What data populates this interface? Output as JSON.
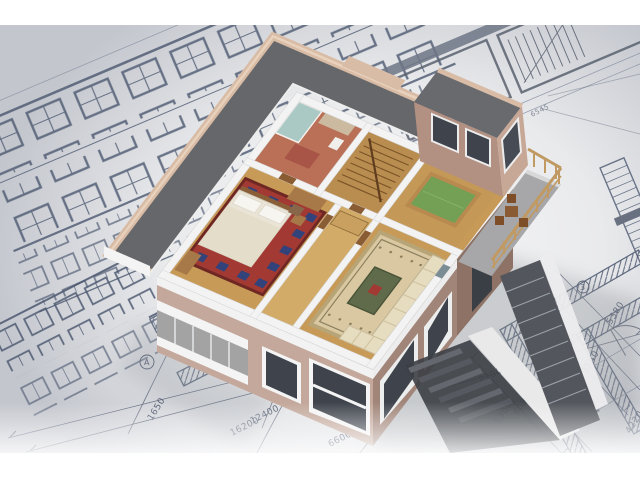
{
  "scene": {
    "description": "Aerial 3D cutaway model of a two-storey house with furnished rooms (bathroom, stair hall, billiard room, bedroom, corridor, living room, terrace) standing on architectural blueprint drawings",
    "colors": {
      "paper": "#ccd0d6",
      "paper_highlight": "#f7f7f8",
      "line_dark": "#4e586e",
      "line_light": "#8a93a4",
      "roof": "#66676a",
      "roof_block": "#696a6d",
      "parapet": "#d9bca6",
      "wall_light": "#c3a89b",
      "wall_dark": "#a18579",
      "wall_pink": "#c7a795",
      "wall_block": "#b29082",
      "white_cut": "#f3f3f3",
      "floor_wood": "#c79a58",
      "floor_wood_light": "#d2ab68",
      "bath_floor": "#b97057",
      "shower_glass": "#a9d3d2",
      "rug_red": "#a23a33",
      "rug_blue": "#32427a",
      "bed": "#eae4d6",
      "carpet_beige": "#d9c8a2",
      "carpet_medallion": "#5f6b4a",
      "sofa": "#e6dcbf",
      "billiard_cloth": "#74a055",
      "billiard_rim": "#b98a4f",
      "terrace": "#a7a7a9",
      "railing_wood": "#c09a62",
      "glass": "#3f444c",
      "stairs_dark": "#53565c",
      "shadow": "#94989f",
      "furniture_wood": "#a87948"
    },
    "annotations": {
      "dims": [
        {
          "text": "1650"
        },
        {
          "text": "16200"
        },
        {
          "text": "12400"
        },
        {
          "text": "2300"
        },
        {
          "text": "6600"
        },
        {
          "text": "2100"
        },
        {
          "text": "5300"
        },
        {
          "text": "6080"
        },
        {
          "text": "2800"
        },
        {
          "text": "1540"
        },
        {
          "text": "4220"
        },
        {
          "text": "5720"
        },
        {
          "text": "15380"
        },
        {
          "text": "5380"
        },
        {
          "text": "6545"
        }
      ],
      "axis_markers": [
        {
          "text": "2"
        },
        {
          "text": "3"
        },
        {
          "text": "A"
        }
      ]
    }
  }
}
